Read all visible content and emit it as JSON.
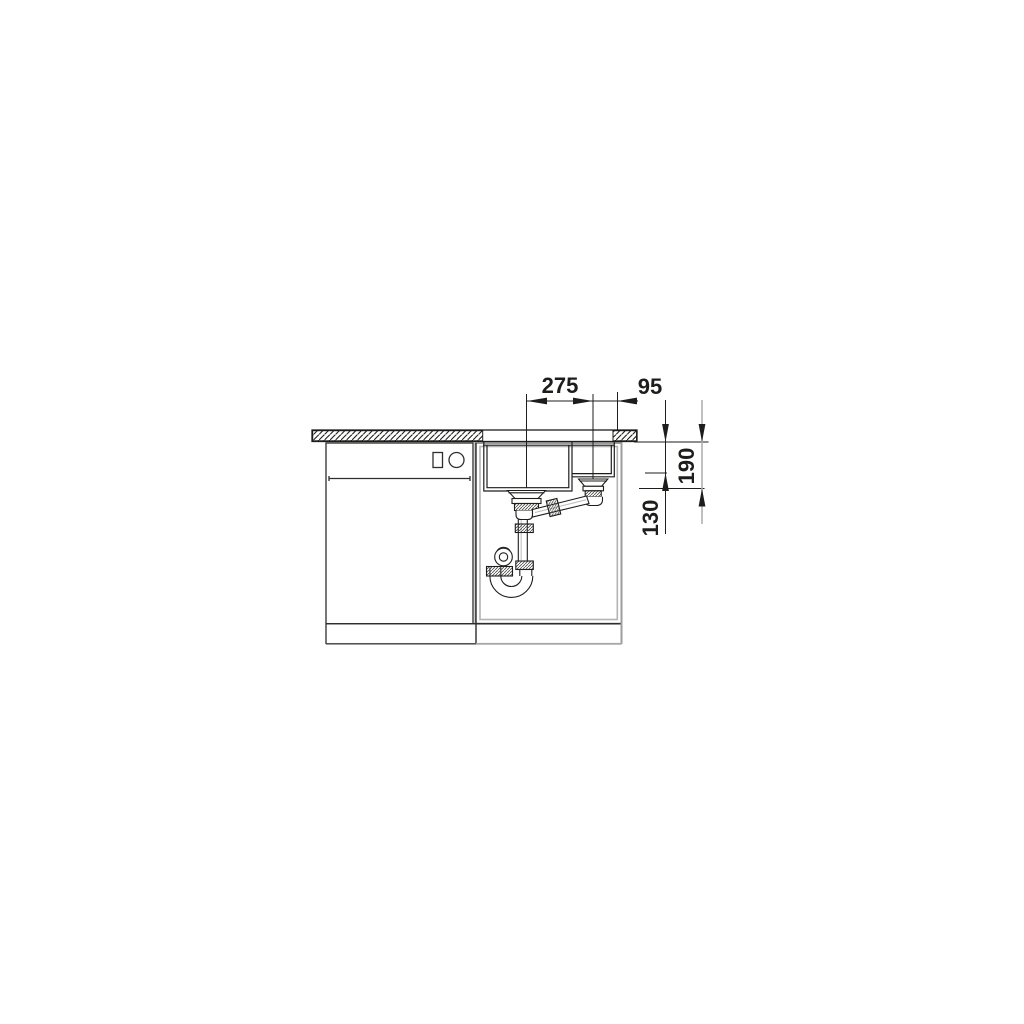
{
  "diagram": {
    "kind": "sink-installation-technical-drawing",
    "dimensions": {
      "top": [
        {
          "label": "275"
        },
        {
          "label": "95"
        }
      ],
      "right": [
        {
          "label": "190"
        },
        {
          "label": "130"
        }
      ]
    },
    "colors": {
      "line": "#1d1d1b",
      "medium_line": "#2e2e2e",
      "light_line": "#a8a8a8",
      "background": "#ffffff",
      "text": "#1d1d1b"
    }
  }
}
